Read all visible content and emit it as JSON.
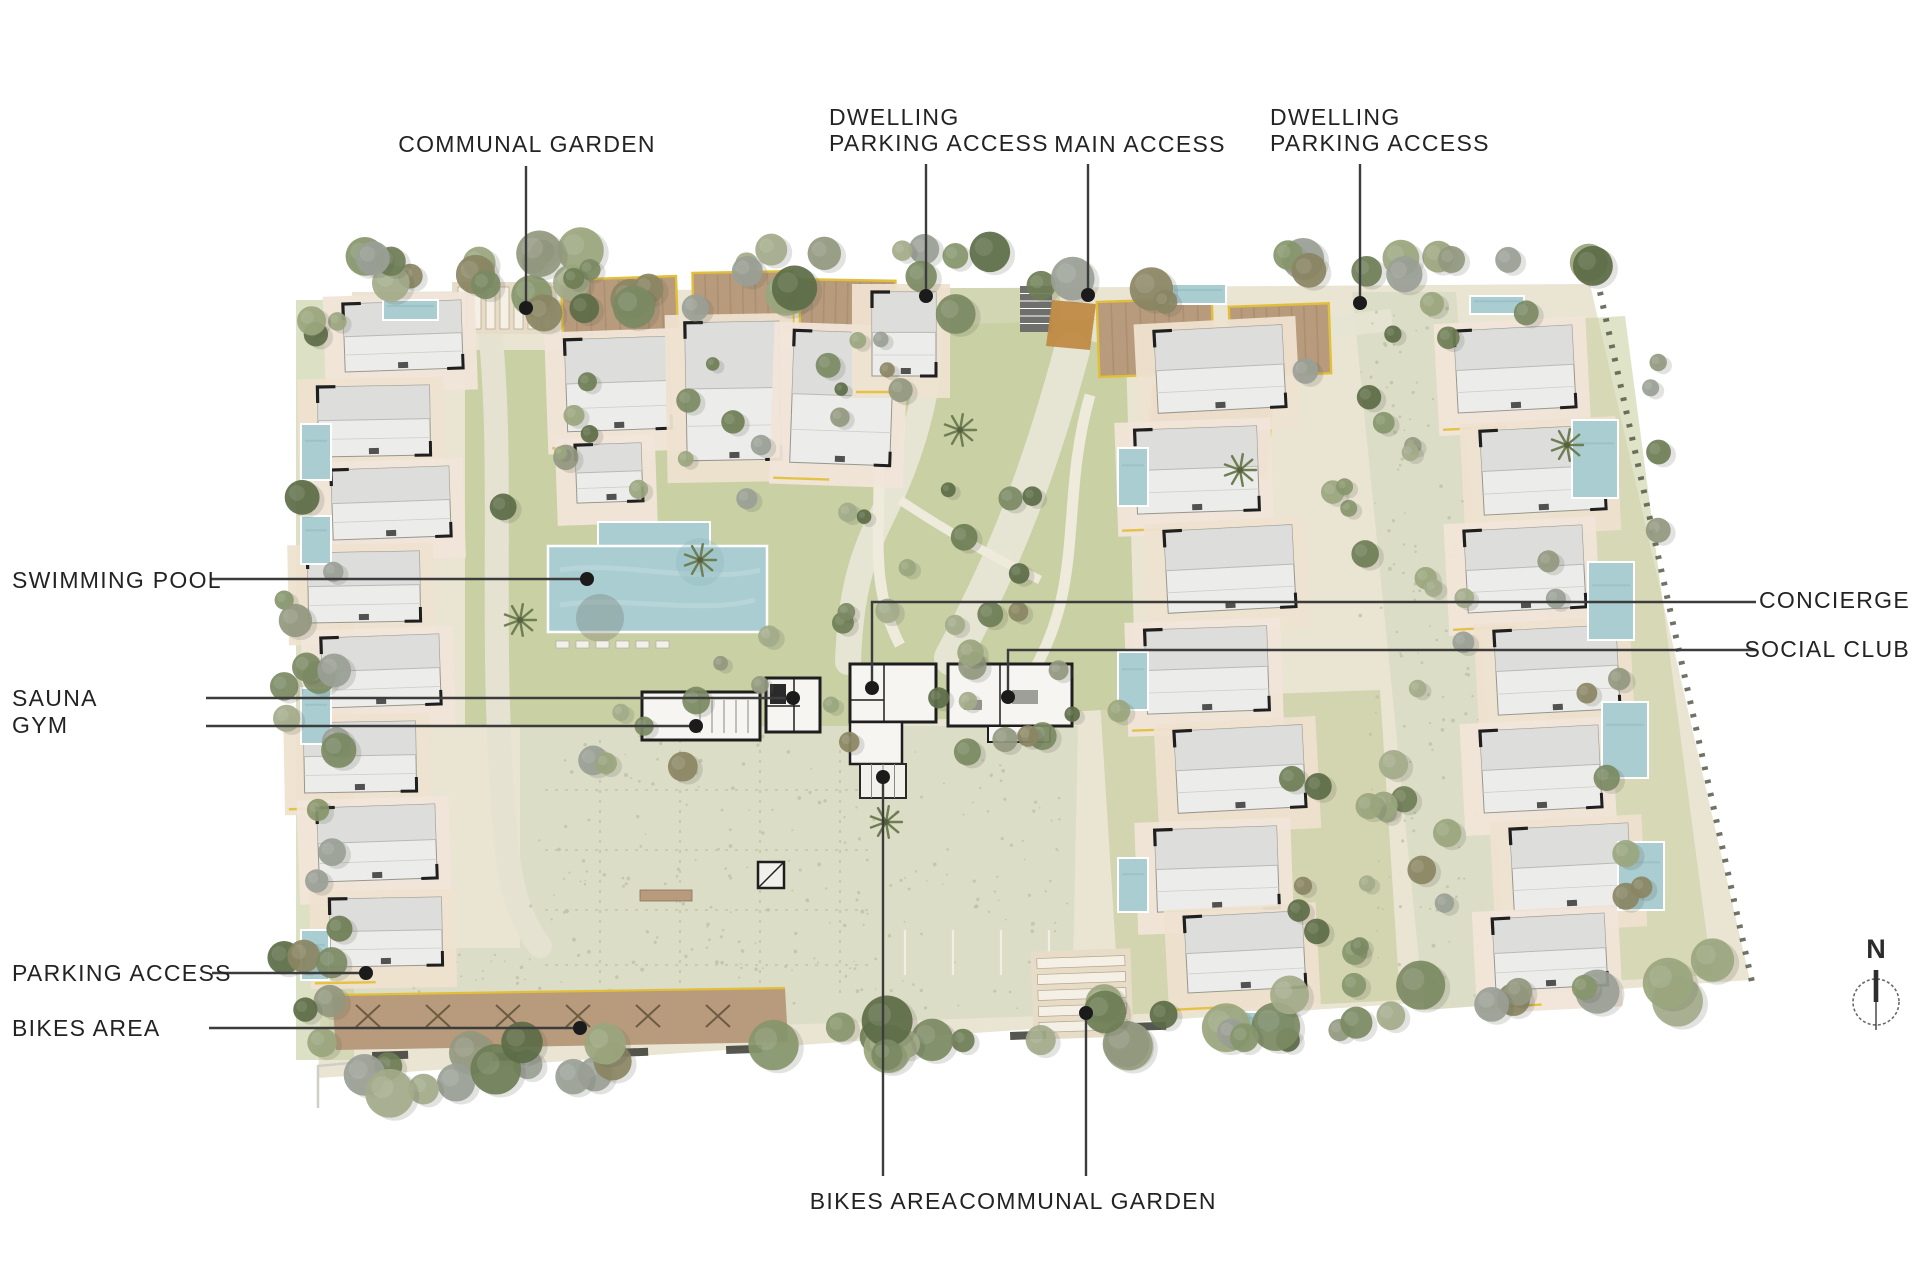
{
  "page": {
    "background": "#ffffff"
  },
  "north_arrow": {
    "label": "N"
  },
  "plan": {
    "palette": {
      "site_base": "#eae4d3",
      "cobble": "#dcddc7",
      "cobble_speckle": "#bfc2a6",
      "lawn": "#c9d0a4",
      "lawn_dark": "#b4bf92",
      "terrace": "#eee1d0",
      "terrace_alt": "#f1e5d9",
      "building": "#ececea",
      "building_shade": "#dbdbd9",
      "pool": "#a9cdd1",
      "pool_dark": "#8fb9c0",
      "parking_brown": "#b79b7c",
      "parking_dark": "#9c8264",
      "accent_yellow": "#e2bf3a",
      "access_orange": "#c08a44",
      "steps_gray": "#6f6f6b",
      "leader_line": "#3c3c3c",
      "leader_dot": "#1b1b1b",
      "text": "#232323",
      "tree_gray": "#9aa096",
      "tree_greens": [
        "#87966b",
        "#6e7e55",
        "#9aa67e",
        "#5c6c47",
        "#93987f",
        "#7b8a63",
        "#a3ab8a",
        "#8a8563"
      ]
    }
  },
  "annotations": [
    {
      "id": "communal-garden-top",
      "lines": [
        "COMMUNAL GARDEN"
      ],
      "x": 527,
      "y": 144,
      "align": "center",
      "leader": {
        "points": [
          [
            526,
            166
          ],
          [
            526,
            308
          ]
        ],
        "dot": [
          526,
          308
        ]
      }
    },
    {
      "id": "dwelling-parking-access-left",
      "lines": [
        "DWELLING",
        "PARKING ACCESS"
      ],
      "x": 829,
      "y": 130,
      "align": "left",
      "leader": {
        "points": [
          [
            926,
            164
          ],
          [
            926,
            296
          ]
        ],
        "dot": [
          926,
          296
        ]
      }
    },
    {
      "id": "main-access",
      "lines": [
        "MAIN ACCESS"
      ],
      "x": 1140,
      "y": 144,
      "align": "center",
      "leader": {
        "points": [
          [
            1088,
            164
          ],
          [
            1088,
            295
          ]
        ],
        "dot": [
          1088,
          295
        ]
      }
    },
    {
      "id": "dwelling-parking-access-right",
      "lines": [
        "DWELLING",
        "PARKING ACCESS"
      ],
      "x": 1270,
      "y": 130,
      "align": "left",
      "leader": {
        "points": [
          [
            1360,
            164
          ],
          [
            1360,
            303
          ]
        ],
        "dot": [
          1360,
          303
        ]
      }
    },
    {
      "id": "swimming-pool",
      "lines": [
        "SWIMMING POOL"
      ],
      "x": 12,
      "y": 580,
      "align": "left",
      "leader": {
        "points": [
          [
            210,
            579
          ],
          [
            587,
            579
          ]
        ],
        "dot": [
          587,
          579
        ]
      }
    },
    {
      "id": "sauna",
      "lines": [
        "SAUNA"
      ],
      "x": 12,
      "y": 698,
      "align": "left",
      "leader": {
        "points": [
          [
            206,
            698
          ],
          [
            793,
            698
          ]
        ],
        "dot": [
          793,
          698
        ]
      }
    },
    {
      "id": "gym",
      "lines": [
        "GYM"
      ],
      "x": 12,
      "y": 725,
      "align": "left",
      "leader": {
        "points": [
          [
            206,
            726
          ],
          [
            696,
            726
          ]
        ],
        "dot": [
          696,
          726
        ]
      }
    },
    {
      "id": "parking-access",
      "lines": [
        "PARKING ACCESS"
      ],
      "x": 12,
      "y": 973,
      "align": "left",
      "leader": {
        "points": [
          [
            212,
            973
          ],
          [
            366,
            973
          ]
        ],
        "dot": [
          366,
          973
        ]
      }
    },
    {
      "id": "bikes-area-left",
      "lines": [
        "BIKES AREA"
      ],
      "x": 12,
      "y": 1028,
      "align": "left",
      "leader": {
        "points": [
          [
            209,
            1028
          ],
          [
            580,
            1028
          ]
        ],
        "dot": [
          580,
          1028
        ]
      }
    },
    {
      "id": "concierge",
      "lines": [
        "CONCIERGE"
      ],
      "x": 1910,
      "y": 600,
      "align": "right",
      "leader": {
        "points": [
          [
            1756,
            602
          ],
          [
            872,
            602
          ],
          [
            872,
            688
          ]
        ],
        "dot": [
          872,
          688
        ]
      }
    },
    {
      "id": "social-club",
      "lines": [
        "SOCIAL CLUB"
      ],
      "x": 1910,
      "y": 649,
      "align": "right",
      "leader": {
        "points": [
          [
            1756,
            650
          ],
          [
            1008,
            650
          ],
          [
            1008,
            697
          ]
        ],
        "dot": [
          1008,
          697
        ]
      }
    },
    {
      "id": "bikes-area-bottom",
      "lines": [
        "BIKES AREA"
      ],
      "x": 884,
      "y": 1201,
      "align": "center",
      "leader": {
        "points": [
          [
            883,
            1176
          ],
          [
            883,
            777
          ]
        ],
        "dot": [
          883,
          777
        ]
      }
    },
    {
      "id": "communal-garden-bottom",
      "lines": [
        "COMMUNAL GARDEN"
      ],
      "x": 1088,
      "y": 1201,
      "align": "center",
      "leader": {
        "points": [
          [
            1086,
            1176
          ],
          [
            1086,
            1013
          ]
        ],
        "dot": [
          1086,
          1013
        ]
      }
    }
  ]
}
